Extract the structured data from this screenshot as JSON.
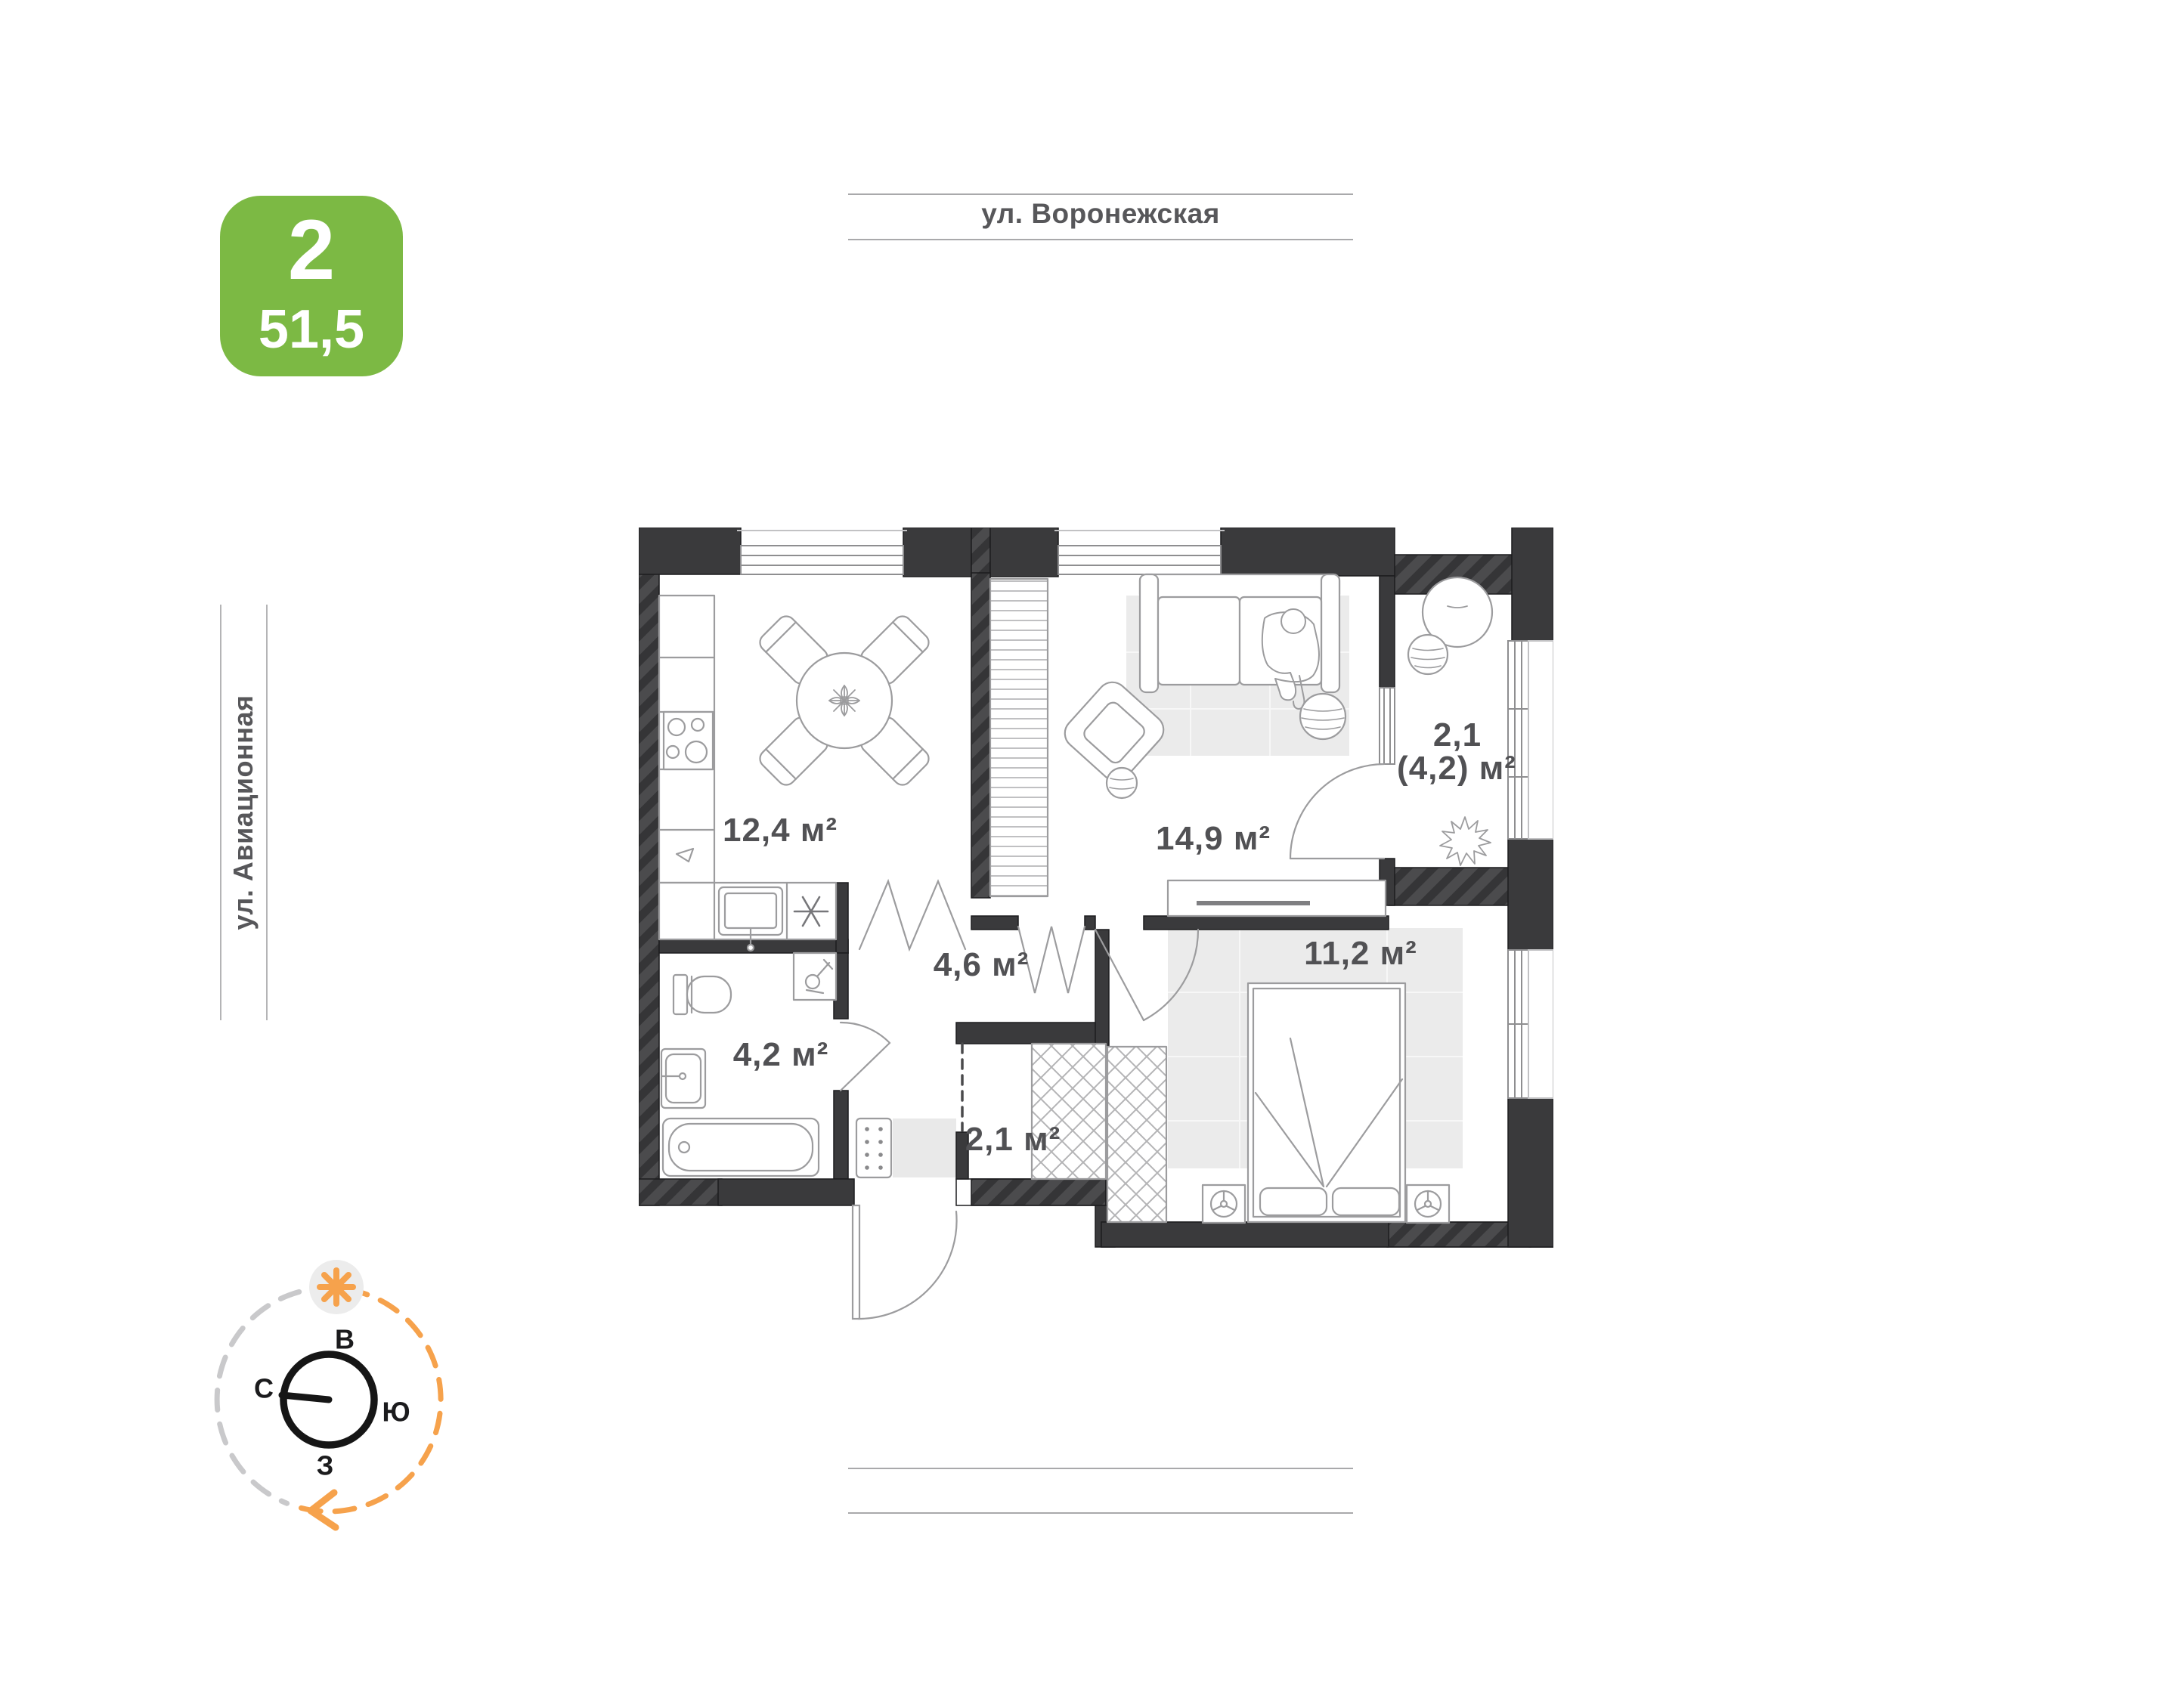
{
  "badge": {
    "rooms_count": "2",
    "total_area": "51,5"
  },
  "streets": {
    "top": "ул. Воронежская",
    "left": "ул. Авиационная"
  },
  "rooms": {
    "kitchen": {
      "area_label": "12,4 м²"
    },
    "living": {
      "area_label": "14,9 м²"
    },
    "balcony": {
      "area_reduced": "2,1",
      "area_full": "(4,2) м²"
    },
    "hallway": {
      "area_label": "4,6 м²"
    },
    "bathroom": {
      "area_label": "4,2 м²"
    },
    "closet": {
      "area_label": "2,1 м²"
    },
    "bedroom": {
      "area_label": "11,2 м²"
    }
  },
  "compass": {
    "east": "В",
    "north": "С",
    "south": "Ю",
    "west": "З"
  },
  "colors": {
    "badge_green": "#7cb944",
    "wall_dark": "#3a3a3c",
    "accent_orange": "#f6a24c",
    "label_gray": "#515154",
    "line_gray": "#a9a9ab"
  }
}
